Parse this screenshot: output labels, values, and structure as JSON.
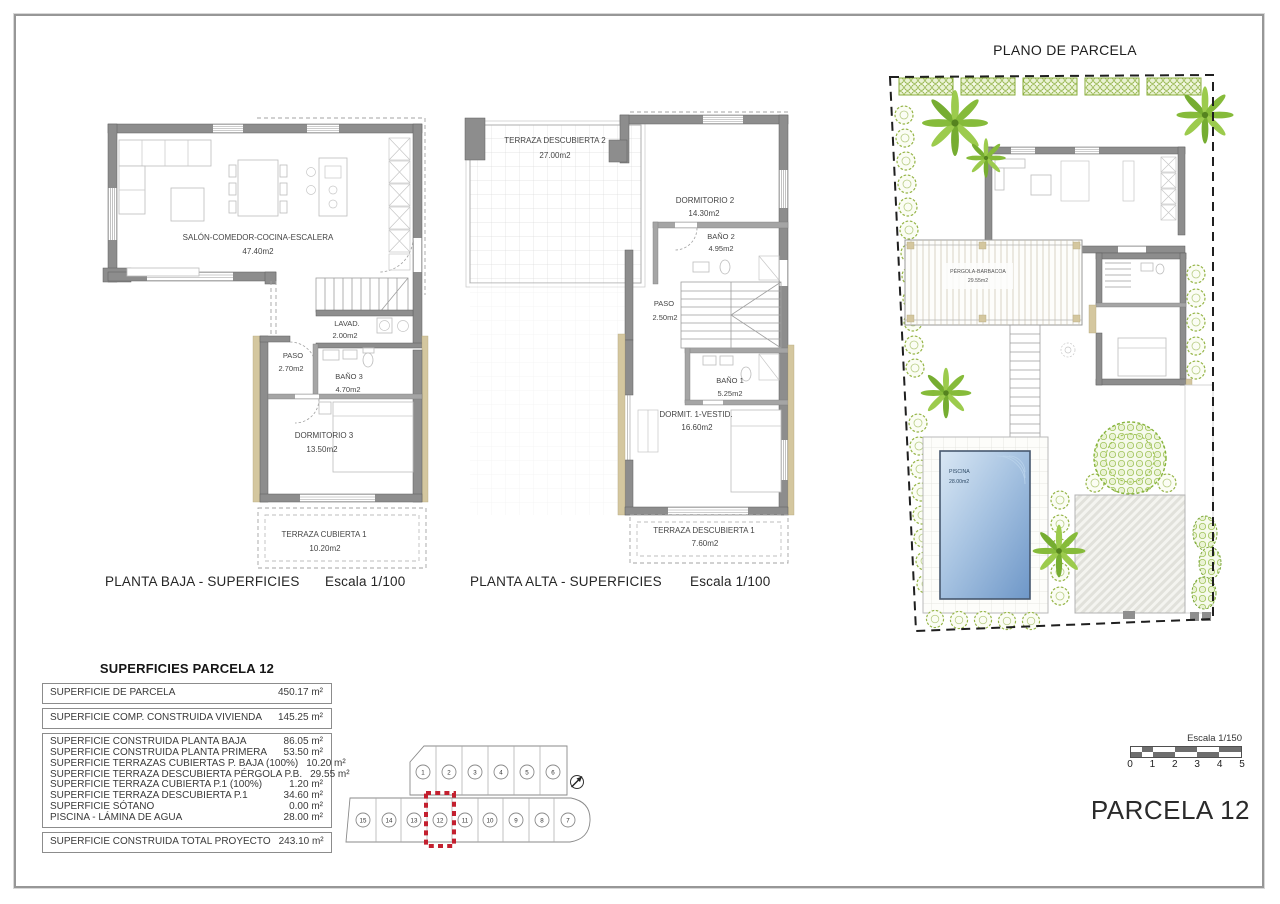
{
  "captions": {
    "ground": {
      "title": "PLANTA BAJA - SUPERFICIES",
      "scale": "Escala 1/100"
    },
    "upper": {
      "title": "PLANTA ALTA - SUPERFICIES",
      "scale": "Escala 1/100"
    },
    "parcel_title": "PLANO DE PARCELA",
    "parcel_label": "PARCELA 12"
  },
  "ground_floor": {
    "salon": {
      "name": "SALÓN-COMEDOR-COCINA-ESCALERA",
      "area": "47.40m2"
    },
    "lavadero": {
      "name": "LAVAD.",
      "area": "2.00m2"
    },
    "paso": {
      "name": "PASO",
      "area": "2.70m2"
    },
    "bano3": {
      "name": "BAÑO 3",
      "area": "4.70m2"
    },
    "dormitorio3": {
      "name": "DORMITORIO 3",
      "area": "13.50m2"
    },
    "terraza_cubierta1": {
      "name": "TERRAZA CUBIERTA 1",
      "area": "10.20m2"
    }
  },
  "upper_floor": {
    "terraza2": {
      "name": "TERRAZA DESCUBIERTA 2",
      "area": "27.00m2"
    },
    "dormitorio2": {
      "name": "DORMITORIO 2",
      "area": "14.30m2"
    },
    "bano2": {
      "name": "BAÑO 2",
      "area": "4.95m2"
    },
    "paso": {
      "name": "PASO",
      "area": "2.50m2"
    },
    "bano1": {
      "name": "BAÑO 1",
      "area": "5.25m2"
    },
    "dormitorio1": {
      "name": "DORMIT. 1-VESTID.",
      "area": "16.60m2"
    },
    "terraza1": {
      "name": "TERRAZA DESCUBIERTA 1",
      "area": "7.60m2"
    }
  },
  "parcel_plan": {
    "pergola": {
      "name": "PÉRGOLA-BARBACOA",
      "area": "29.55m2"
    },
    "piscina": {
      "name": "PISCINA",
      "area": "28.00m2"
    },
    "scale_bar": {
      "label": "Escala 1/150",
      "ticks": [
        "0",
        "1",
        "2",
        "3",
        "4",
        "5"
      ]
    }
  },
  "areas_table": {
    "title": "SUPERFICIES PARCELA 12",
    "box1": {
      "label": "SUPERFICIE DE PARCELA",
      "value": "450.17 m²"
    },
    "box2": {
      "label": "SUPERFICIE COMP. CONSTRUIDA VIVIENDA",
      "value": "145.25 m²"
    },
    "box3": [
      {
        "label": "SUPERFICIE CONSTRUIDA PLANTA BAJA",
        "value": "86.05 m²"
      },
      {
        "label": "SUPERFICIE CONSTRUIDA PLANTA PRIMERA",
        "value": "53.50 m²"
      },
      {
        "label": "SUPERFICIE TERRAZAS CUBIERTAS P. BAJA (100%)",
        "value": "10.20 m²"
      },
      {
        "label": "SUPERFICIE TERRAZA DESCUBIERTA PÉRGOLA P.B.",
        "value": "29.55 m²"
      },
      {
        "label": "SUPERFICIE TERRAZA CUBIERTA P.1 (100%)",
        "value": "1.20 m²"
      },
      {
        "label": "SUPERFICIE TERRAZA DESCUBIERTA P.1",
        "value": "34.60 m²"
      },
      {
        "label": "SUPERFICIE SÓTANO",
        "value": "0.00 m²"
      },
      {
        "label": "PISCINA - LÁMINA DE AGUA",
        "value": "28.00 m²"
      }
    ],
    "box4": {
      "label": "SUPERFICIE CONSTRUIDA TOTAL PROYECTO",
      "value": "243.10 m²"
    }
  },
  "site_map": {
    "top_row": [
      "1",
      "2",
      "3",
      "4",
      "5",
      "6"
    ],
    "bottom_row": [
      "15",
      "14",
      "13",
      "12",
      "11",
      "10",
      "9",
      "8",
      "7"
    ],
    "highlighted_plot": "12"
  },
  "colors": {
    "wall": "#8d8d8d",
    "tan_accent": "#d4c79f",
    "pool_blue": "#6e97c8",
    "vegetation_green": "#86bb3a",
    "highlight_red": "#c3202f"
  }
}
